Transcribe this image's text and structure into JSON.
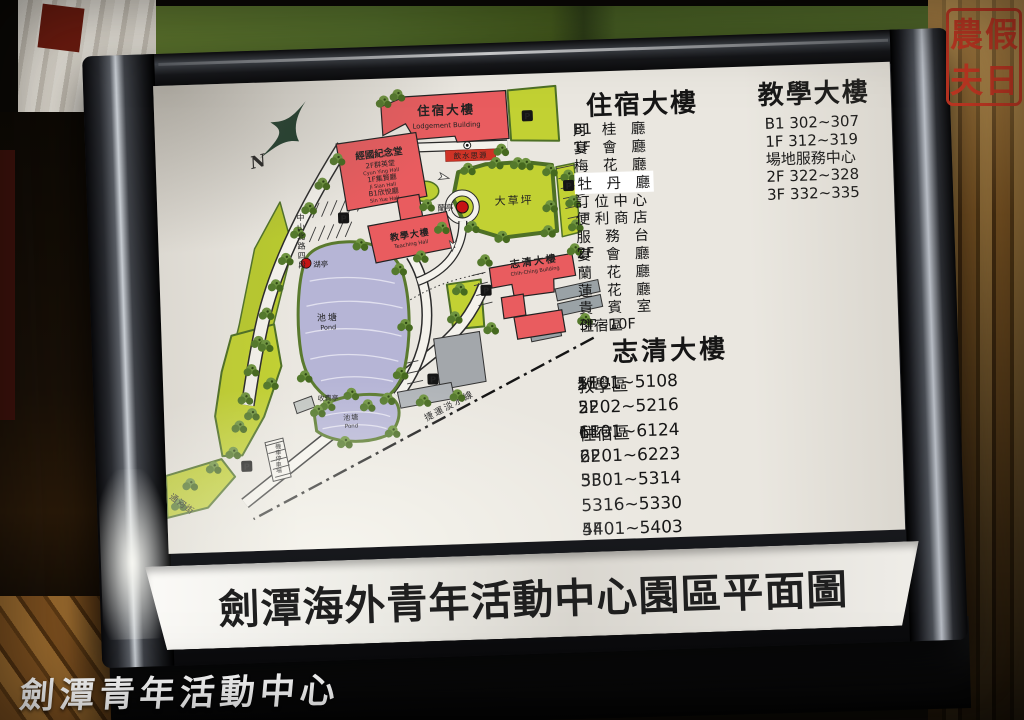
{
  "watermark": "劍潭青年活動中心",
  "stamp": {
    "chars": [
      "農",
      "假",
      "夫",
      "日"
    ]
  },
  "board": {
    "title": "劍潭海外青年活動中心園區平面圖"
  },
  "legend": {
    "header_left": "住宿大樓",
    "header_right": "教學大樓",
    "left_rows": [
      {
        "floor": "B1",
        "name": "月　桂　廳"
      },
      {
        "floor": "1F",
        "name": "宴　會　廳"
      },
      {
        "floor": "",
        "name": "梅　花　廳"
      },
      {
        "floor": "",
        "name": "牡　丹　廳"
      },
      {
        "floor": "",
        "name": "訂 位 中 心"
      },
      {
        "floor": "",
        "name": "便 利 商 店"
      },
      {
        "floor": "",
        "name": "服　務　台"
      },
      {
        "floor": "2F",
        "name": "宴　會　廳"
      },
      {
        "floor": "",
        "name": "蘭　花　廳"
      },
      {
        "floor": "",
        "name": "蓮　花　廳"
      },
      {
        "floor": "",
        "name": "貴　賓　室"
      },
      {
        "floor": "3F~10F",
        "name": "住宿區"
      }
    ],
    "right_rows": [
      "B1 302~307",
      "1F 312~319",
      "場地服務中心",
      "2F 322~328",
      "3F 332~335"
    ],
    "section2_header": "志清大樓",
    "section2_rows": [
      {
        "area": "教學區",
        "floor": "1F",
        "range": "5101~5108"
      },
      {
        "area": "",
        "floor": "2F",
        "range": "5202~5216"
      },
      {
        "area": "住宿區",
        "floor": "1F",
        "range": "6101~6124"
      },
      {
        "area": "",
        "floor": "2F",
        "range": "6201~6223"
      },
      {
        "area": "",
        "floor": "3F",
        "range": "5301~5314"
      },
      {
        "area": "",
        "floor": "",
        "range": "5316~5330"
      },
      {
        "area": "",
        "floor": "4F",
        "range": "5401~5403"
      }
    ]
  },
  "map": {
    "compass": "N",
    "labels": {
      "lodgement_zh": "住宿大樓",
      "lodgement_en": "Lodgement Building",
      "memorial_lines": [
        "經國紀念堂",
        "2F群英堂",
        "Cyun Ying Hall",
        "1F集賢廳",
        "Ji Sian Hall",
        "B1欣悅廳",
        "Sin Yue Hall"
      ],
      "teaching_zh": "教學大樓",
      "teaching_en": "Teaching Hall",
      "chihching_zh": "志清大樓",
      "chihching_en": "Chih-Ching Building",
      "lawn": "大草坪",
      "pond_zh": "池塘",
      "pond_en": "Pond",
      "lan_pavilion": "蘭亭",
      "lake_pavilion": "湖亭",
      "spring_plaque": "飲水思源",
      "toll_booth": "收費亭",
      "moto_parking": "機車停車場",
      "road_zhongshan": "中山北路四段",
      "road_tonghe": "通河街",
      "mrt_line": "捷運淡水線",
      "parking": "P"
    }
  }
}
